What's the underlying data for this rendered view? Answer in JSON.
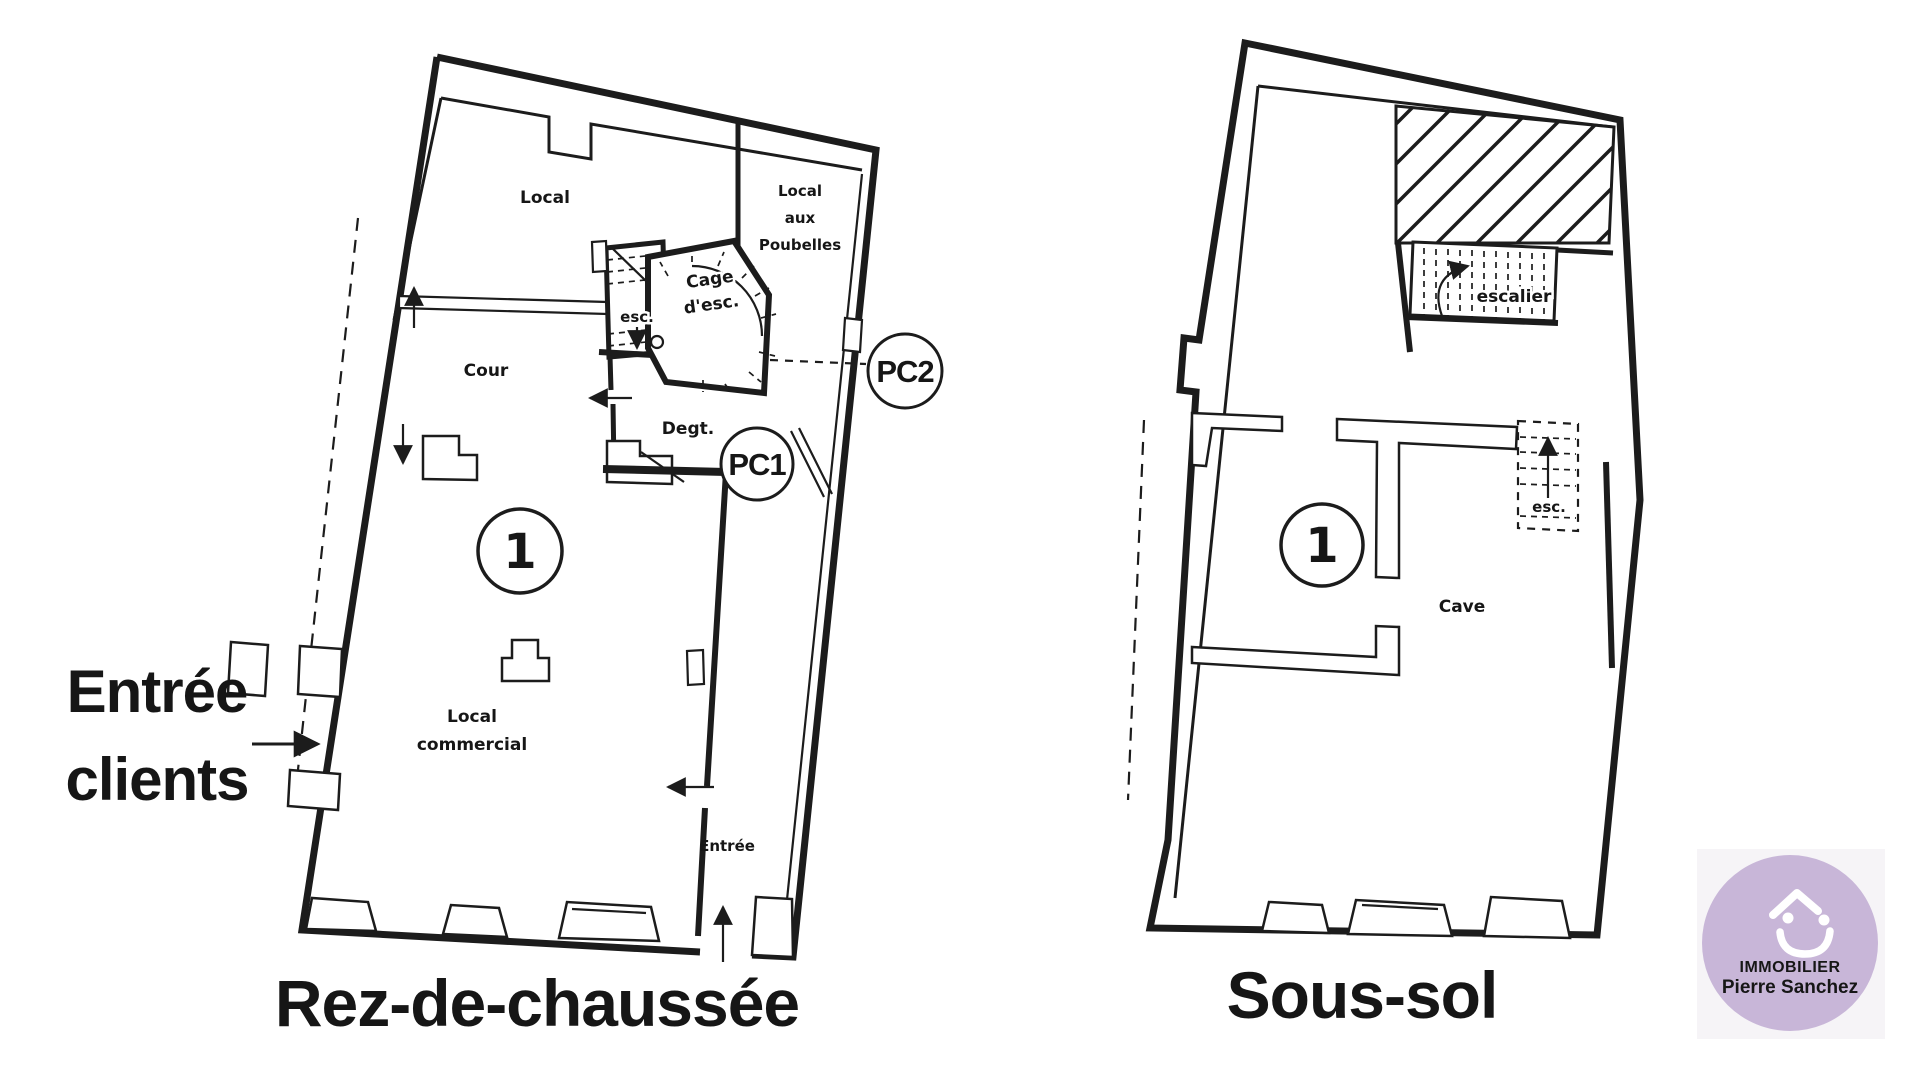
{
  "colors": {
    "background": "#ffffff",
    "ink": "#1c1c1c",
    "navy": "#2e3a66",
    "logo_circle": "#c8b6d8",
    "logo_text": "#ffffff",
    "logo_bg": "#f6f4f7"
  },
  "annotations": {
    "entree_clients_line1": "Entrée",
    "entree_clients_line2": "clients"
  },
  "plans": {
    "ground_floor": {
      "title": "Rez-de-chaussée",
      "unit_number": "1",
      "labels": {
        "local": "Local",
        "poubelles_line1": "Local",
        "poubelles_line2": "aux",
        "poubelles_line3": "Poubelles",
        "cage_line1": "Cage",
        "cage_line2": "d'esc.",
        "esc": "esc.",
        "cour": "Cour",
        "degt": "Degt.",
        "pc1": "PC1",
        "pc2": "PC2",
        "commercial_line1": "Local",
        "commercial_line2": "commercial",
        "entree": "Entrée"
      }
    },
    "basement": {
      "title": "Sous-sol",
      "unit_number": "1",
      "labels": {
        "escalier": "escalier",
        "esc": "esc.",
        "cave": "Cave"
      }
    }
  },
  "logo": {
    "line1": "IMMOBILIER",
    "line2": "Pierre Sanchez",
    "icon": "house-smile-icon"
  }
}
